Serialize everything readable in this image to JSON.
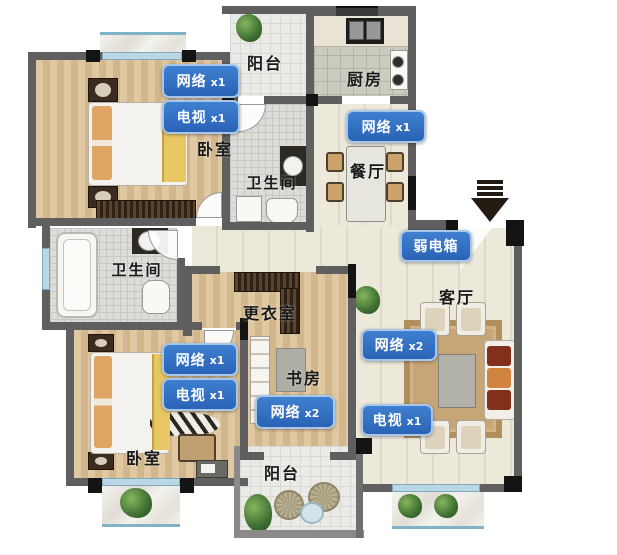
{
  "rooms": {
    "balcony_top": "阳台",
    "kitchen": "厨房",
    "bedroom_tl": "卧室",
    "bathroom_top": "卫生间",
    "dining": "餐厅",
    "bathroom_left": "卫生间",
    "dressing": "更衣室",
    "living": "客厅",
    "study": "书房",
    "bedroom_bl": "卧室",
    "balcony_bottom": "阳台"
  },
  "ports": {
    "bedroom_tl_network": {
      "type": "网络",
      "count": "x1"
    },
    "bedroom_tl_tv": {
      "type": "电视",
      "count": "x1"
    },
    "dining_network": {
      "type": "网络",
      "count": "x1"
    },
    "weak_current_box": {
      "type": "弱电箱",
      "count": ""
    },
    "bedroom_bl_network": {
      "type": "网络",
      "count": "x1"
    },
    "bedroom_bl_tv": {
      "type": "电视",
      "count": "x1"
    },
    "study_network": {
      "type": "网络",
      "count": "x2"
    },
    "living_network": {
      "type": "网络",
      "count": "x2"
    },
    "living_tv": {
      "type": "电视",
      "count": "x1"
    }
  },
  "icons": {
    "entrance_arrow": "entrance-arrow-down"
  },
  "colors": {
    "label_bg": "#2e6fc4",
    "label_border": "#a8c6e8",
    "wall": "#5f5f5f",
    "wood_floor": "#d9c098",
    "tile_floor": "#ece8da"
  }
}
